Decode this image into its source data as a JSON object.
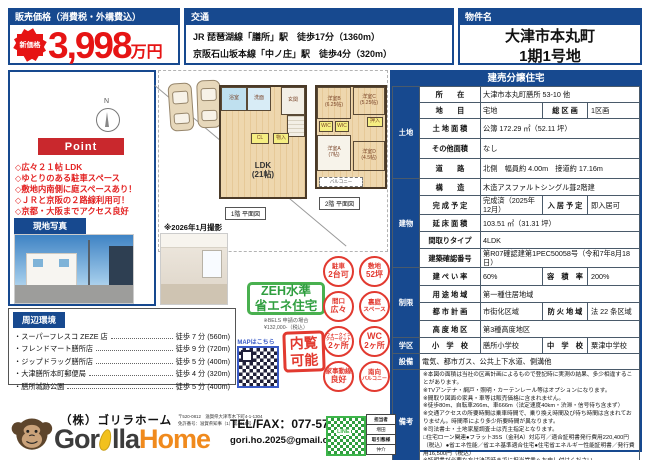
{
  "header": {
    "price": {
      "title": "販売価格（消費税・外構費込）",
      "badge": "新価格",
      "amount": "3,998",
      "unit": "万円"
    },
    "access": {
      "title": "交通",
      "line1": "JR 琵琶湖線「膳所」駅　徒歩17分（1360m）",
      "line2": "京阪石山坂本線「中ノ庄」駅　徒歩4分（320m）"
    },
    "property": {
      "title": "物件名",
      "line1": "大津市本丸町",
      "line2": "1期1号地"
    }
  },
  "point": {
    "title": "Point",
    "items": [
      "◇広々２１帖 LDK",
      "◇ゆとりのある駐車スペース",
      "◇敷地内南側に庭スペースあり！",
      "◇ＪＲと京阪の２路線利用可！",
      "◇京都・大阪までアクセス良好"
    ]
  },
  "site_photo": {
    "title": "現地写真",
    "caption": "※2026年1月撮影"
  },
  "environment": {
    "title": "周辺環境",
    "items": [
      {
        "name": "・スーパーフレスコ ZEZE 店",
        "time": "徒歩 7 分 (560m)"
      },
      {
        "name": "・フレンドマート膳所店",
        "time": "徒歩 9 分 (720m)"
      },
      {
        "name": "・ジップドラッグ膳所店",
        "time": "徒歩 5 分 (400m)"
      },
      {
        "name": "・大津膳所本町郵便局",
        "time": "徒歩 4 分 (320m)"
      },
      {
        "name": "・膳所城跡公園",
        "time": "徒歩 5 分 (400m)"
      }
    ]
  },
  "plans": {
    "compass_label": "N",
    "floor1_caption": "1階 平面図",
    "floor2_caption": "2階 平面図",
    "floor1": {
      "bath": "浴室",
      "wash": "洗面",
      "entrance": "玄関",
      "cl": "CL",
      "storage": "物入",
      "ldk": "LDK\n(21帖)"
    },
    "floor2": {
      "room_b": "洋室B\n(6.25帖)",
      "room_c": "洋室C\n(5.25帖)",
      "wic1": "WIC",
      "wic2": "WIC",
      "oshiire": "押入",
      "room_a": "洋室A\n(7帖)",
      "room_d": "洋室D\n(4.5帖)",
      "balcony": "バルコニー"
    }
  },
  "badges": {
    "zeh_line1": "ZEH水準",
    "zeh_line2": "省エネ住宅",
    "zeh_note1": "※BELS 申請の場合",
    "zeh_note2": "¥132,000-（税込）",
    "map_label": "MAPはこちら",
    "inspection": "内覧\n可能",
    "stamps": [
      {
        "top": "駐車",
        "bottom": "2台可"
      },
      {
        "top": "敷地",
        "bottom": "52坪"
      },
      {
        "top": "間口",
        "bottom": "広々"
      },
      {
        "top": "裏庭",
        "bottom": "スペース"
      },
      {
        "top": "ウォークイン\nクローゼット",
        "bottom": "2ヶ所"
      },
      {
        "top": "WC",
        "bottom": "2ヶ所"
      },
      {
        "top": "家事動線",
        "bottom": "良好"
      },
      {
        "top": "南向",
        "bottom": "バルコニー"
      }
    ]
  },
  "spec": {
    "title": "建売分譲住宅",
    "groups": {
      "land": "土地",
      "building": "建物",
      "restriction": "制限",
      "school": "学区",
      "equipment": "設備",
      "remarks": "備考"
    },
    "rows": {
      "location": {
        "label": "所　　在",
        "value": "大津市本丸町膳所 53-10 他"
      },
      "category": {
        "label": "地　　目",
        "value": "宅地",
        "label2": "総 区 画",
        "value2": "1区画"
      },
      "land_area": {
        "label": "土 地 面 積",
        "value": "公簿 172.29 ㎡（52.11 坪）"
      },
      "other_area": {
        "label": "その他面積",
        "value": "なし"
      },
      "road": {
        "label": "道　　路",
        "value": "北側　幅員約 4.00m　接道約 17.16m"
      },
      "structure": {
        "label": "構　　造",
        "value": "木造アスファルトシングル葺2階建"
      },
      "completion": {
        "label": "完 成 予 定",
        "value": "完成済（2025年12月）",
        "label2": "入 居 予 定",
        "value2": "即入居可"
      },
      "floor_area": {
        "label": "延 床 面 積",
        "value": "103.51 ㎡（31.31 坪）"
      },
      "layout": {
        "label": "間取りタイプ",
        "value": "4LDK"
      },
      "confirmation": {
        "label": "建築確認番号",
        "value": "第R07確認建第1PEC50058号（令和7年8月18日）"
      },
      "coverage": {
        "label": "建 ぺ い 率",
        "value": "60%",
        "label2": "容　積　率",
        "value2": "200%"
      },
      "use_zone": {
        "label": "用 途 地 域",
        "value": "第一種住居地域"
      },
      "city_plan": {
        "label": "都 市 計 画",
        "value": "市街化区域",
        "label2": "防 火 地 域",
        "value2": "法 22 条区域"
      },
      "height_zone": {
        "label": "高 度 地 区",
        "value": "第3種高度地区"
      },
      "school": {
        "label": "小　学　校",
        "value": "膳所小学校",
        "label2": "中　学　校",
        "value2": "粟津中学校"
      },
      "equipment": {
        "value": "電気、都市ガス、公共上下水道、側溝他"
      },
      "remarks": {
        "value": "※本図の面積は当社の区画計画によるもので登記時に実測の結果、多少相違することがあります。\n※TVアンテナ・網戸・照明・カーテンレール等はオプションになります。\n※間取り図面の家具・車等は販売価格に含まれません。\n※徒歩80m、自転車266m、車666m（法定速度40km・渋滞・信号待ち含まず）\n※交通アクセスの所要時間は乗車時間で、乗り換え時間及び待ち時間は含まれておりません。時間帯により多少所要時間が異なります。\n※司法書士・土地家屋調査士は売主指定となります。\n□住宅ローン関連●フラット35S（金利A）対応可／適合証明書発行費用220,400円（税込）●省エネ性能／省エネ基準適合住宅●住宅省エネルギー性能証明書／発行費用16,500円（税込）\n※証明書が必要な方は決済時までに担当営業へお申し付けください"
      }
    }
  },
  "footer": {
    "company": "（株）ゴリラホーム",
    "logo_gor": "Gor",
    "logo_lla": "lla",
    "logo_home": "Home",
    "address_line1": "〒520-0812　滋賀県大津市木下町4-1-1304",
    "address_line2": "免許番号：滋賀県知事（1）第4010号",
    "telfax": "TEL/FAX：077-576-6763",
    "email": "gori.ho.2025@gmail.com",
    "line_label": "LINE",
    "staff": {
      "label1": "担当者",
      "value1": "増田",
      "label2": "取引態様",
      "value2": "仲介"
    }
  }
}
